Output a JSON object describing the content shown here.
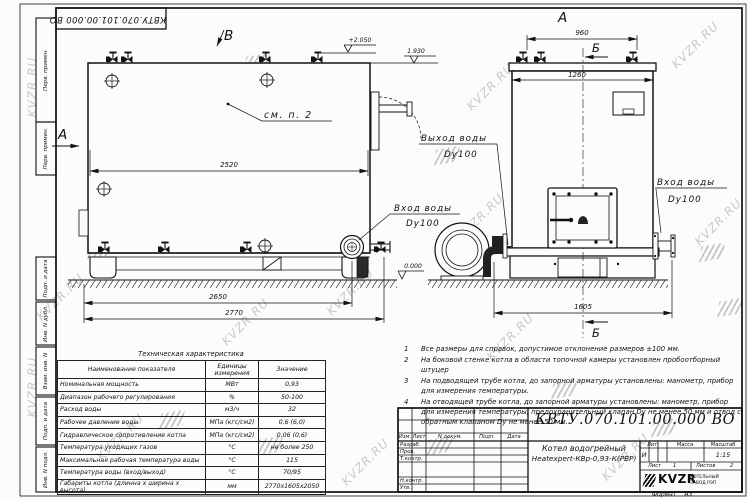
{
  "watermark": {
    "text": "KVZR.RU"
  },
  "sheet": {
    "designation": "КВТУ.070.101.00.000 ВО",
    "margin_boxes": [
      "Перв. примен.",
      "Перв. примен.",
      "Подп. и дата",
      "Инв. N дубл.",
      "Взам. инв. N",
      "Подп. и дата",
      "Инв. N подл."
    ],
    "format_label": "Формат",
    "format_value": "А3"
  },
  "drawing": {
    "section_a_side": "А",
    "view_b": "В",
    "view_a_top": "А",
    "section_b_top": "Б",
    "section_b_bottom": "Б",
    "see_note": "см. п. 2",
    "callout_outlet_line1": "Выход воды",
    "callout_outlet_line2": "Dy100",
    "callout_inlet_left_line1": "Вход воды",
    "callout_inlet_left_line2": "Dy100",
    "callout_inlet_right_line1": "Вход воды",
    "callout_inlet_right_line2": "Dy100",
    "elev_top": "+2.050",
    "elev_mid": "1.930",
    "elev_zero": "0.000",
    "dim_2520": "2520",
    "dim_2650": "2650",
    "dim_2770": "2770",
    "dim_960": "960",
    "dim_1260": "1260",
    "dim_1605": "1605"
  },
  "tech_table": {
    "title": "Техническая характеристика",
    "headers": [
      "Наименование показателя",
      "Единицы измерения",
      "Значение"
    ],
    "rows": [
      [
        "Номинальная мощность",
        "МВт",
        "0,93"
      ],
      [
        "Диапазон рабочего регулирования",
        "%",
        "50-100"
      ],
      [
        "Расход воды",
        "м3/ч",
        "32"
      ],
      [
        "Рабочее давление воды",
        "МПа (кгс/см2)",
        "0,6 (6,0)"
      ],
      [
        "Гидравлическое сопротивление котла",
        "МПа (кгс/см2)",
        "0,06 (0,6)"
      ],
      [
        "Температура уходящих газов",
        "°С",
        "не более 250"
      ],
      [
        "Максимальная рабочая температура воды",
        "°С",
        "115"
      ],
      [
        "Температура воды (вход/выход)",
        "°С",
        "70/95"
      ],
      [
        "Габариты котла (длинна х ширина х высота)",
        "мм",
        "2770х1605х2050"
      ]
    ]
  },
  "notes": [
    {
      "num": "1",
      "text": "Все размеры для справок, допустимое отклонение размеров ±100 мм."
    },
    {
      "num": "2",
      "text": "На боковой стенке котла в области топочной камеры установлен пробоотборный штуцер"
    },
    {
      "num": "3",
      "text": "На  подводящей трубе котла, до запорной арматуры установлены: манометр, прибор для измерения температуры."
    },
    {
      "num": "4",
      "text": "На отводящей трубе котла, до запорной арматуры установлены: манометр, прибор для измерения температуры, предохранительный клапан Dу не менее 50 мм и отвод с обратным клапаном Dу не менее 50 мм."
    }
  ],
  "title_block": {
    "doc_name_line1": "Котел водогрейный",
    "doc_name_line2": "Heatexpert-КВр-0,93-К(РВР)",
    "col_izm": "Изм.",
    "col_list": "Лист",
    "col_ndoc": "N докум.",
    "col_podp": "Подп.",
    "col_data": "Дата",
    "row_razrab": "Разраб.",
    "row_prov": "Пров.",
    "row_tkontr": "Т.контр.",
    "row_nkontr": "Н.контр.",
    "row_utv": "Утв.",
    "lit_label": "Лит.",
    "mass_label": "Масса",
    "scale_label": "Масштаб",
    "lit_value": "И",
    "scale_value": "1:15",
    "sheet_label": "Лист",
    "sheet_value": "1",
    "sheets_label": "Листов",
    "sheets_value": "2",
    "brand": "KVZR",
    "brand_line1": "КОТЕЛЬНЫЙ",
    "brand_line2": "ЗАВОД РЭП"
  }
}
